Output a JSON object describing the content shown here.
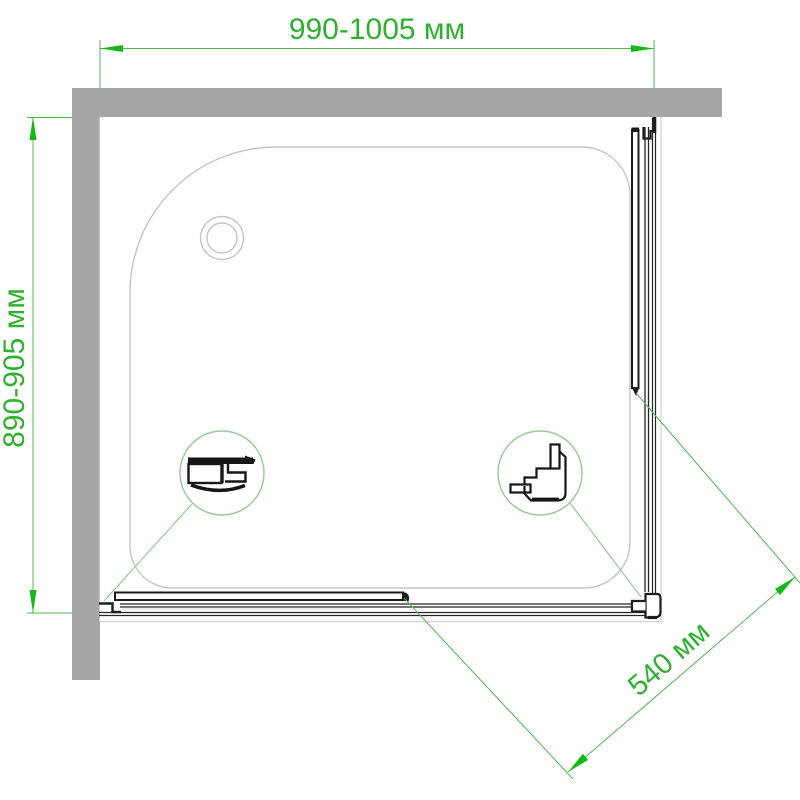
{
  "page": {
    "description": "Technical top-view plan drawing of a corner shower enclosure with tray, sliding doors, wall sections and dimension callouts"
  },
  "dimensions": {
    "width": {
      "label": "990-1005 мм"
    },
    "depth": {
      "label": "890-905 мм"
    },
    "diagonal": {
      "label": "540 мм"
    }
  },
  "details": {
    "left_detail": "wall-profile cross-section magnifier",
    "right_detail": "corner-profile cross-section magnifier"
  },
  "colors": {
    "dimension_text_green": "#2fb12f",
    "dimension_line_green": "#53b553",
    "arrow_green": "#12bb12",
    "detail_circle_green": "#94cb94",
    "wall_gray": "#a6a6a6",
    "tray_outline_gray": "#c5c5c5",
    "frame_gray": "#c9c9c9",
    "profile_black": "#1c1c1c"
  }
}
